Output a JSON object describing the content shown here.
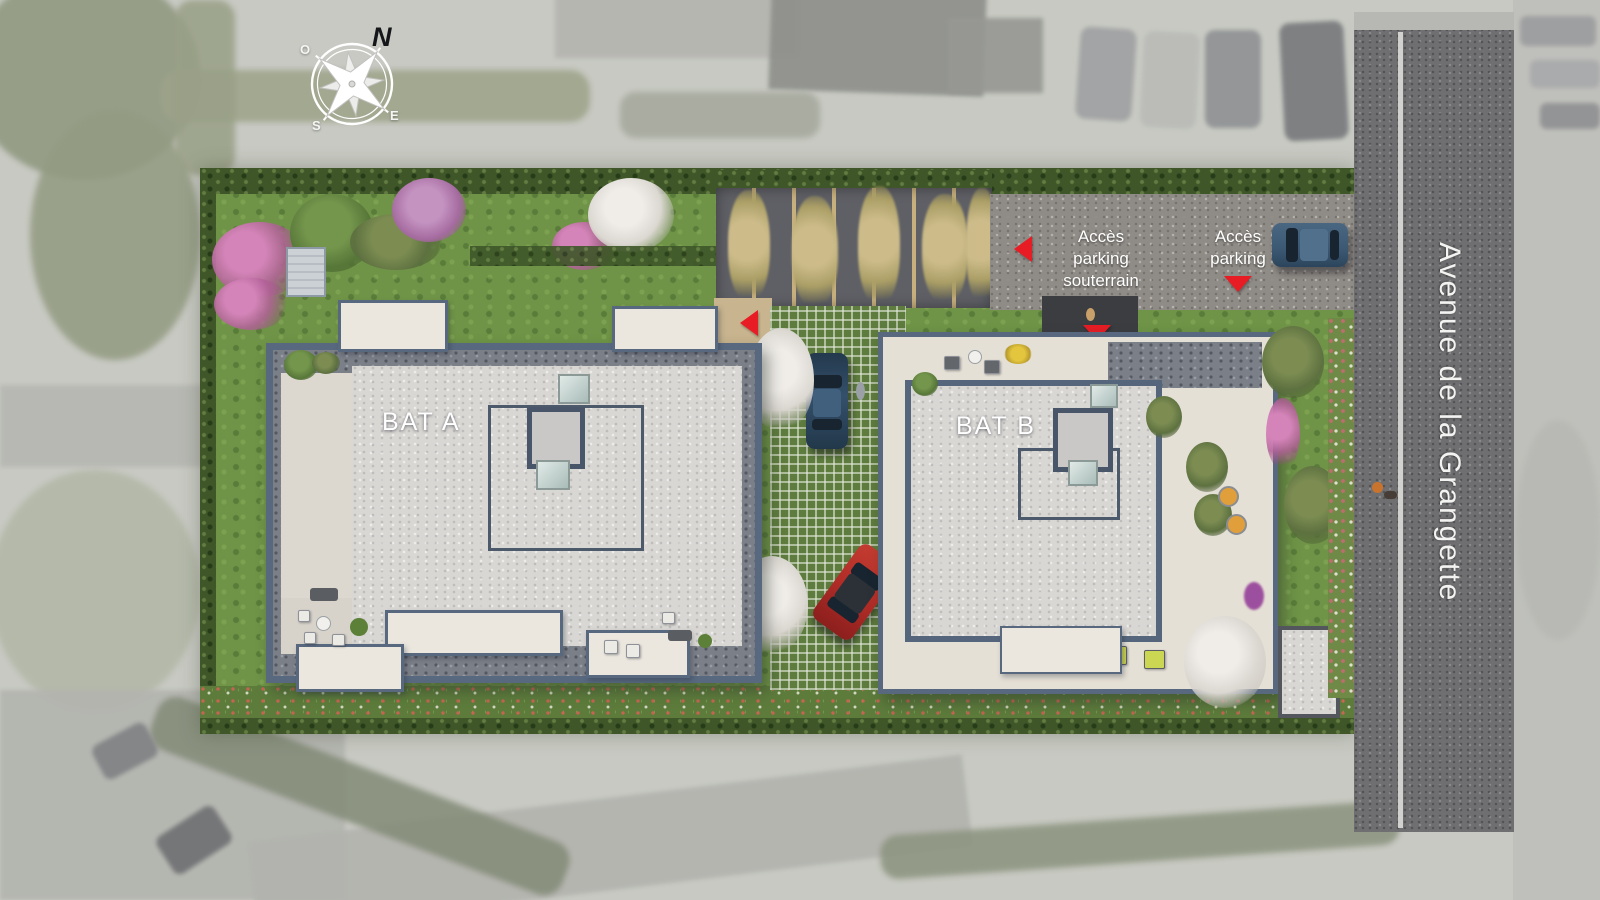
{
  "compass": {
    "north": "N",
    "west": "O",
    "south": "S",
    "east": "E"
  },
  "buildings": {
    "a": "BAT A",
    "b": "BAT B"
  },
  "access": {
    "underground_line1": "Accès",
    "underground_line2": "parking souterrain",
    "parking_line1": "Accès",
    "parking_line2": "parking"
  },
  "street": {
    "name": "Avenue de la Grangette"
  },
  "colors": {
    "accent_red": "#e81c24",
    "lawn": "#6f9447",
    "hedge": "#3f5629",
    "roof": "#d9d7d3",
    "parapet": "#58697f",
    "deck": "#e5e0d6",
    "road": "#6f6e70",
    "asphalt": "#8f8b86",
    "paver_green": "#5e7c3e",
    "path_tan": "#c8b48e",
    "car_blue": "#3d5a75",
    "car_navy": "#35506b",
    "car_red": "#b22d28"
  }
}
